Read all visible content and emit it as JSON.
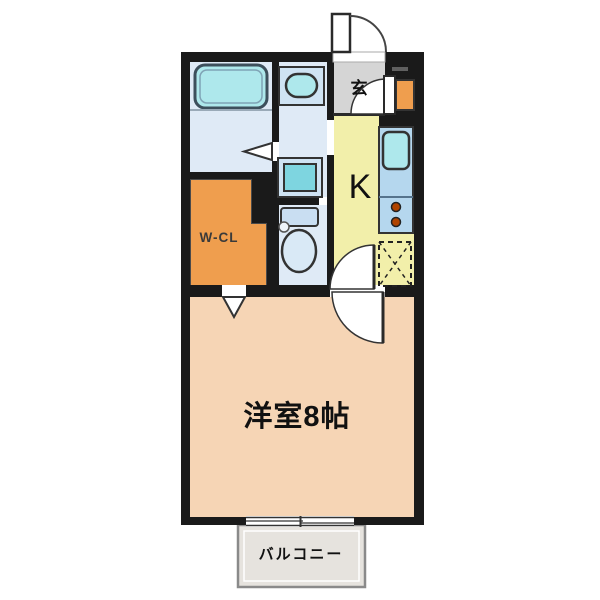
{
  "floor_plan": {
    "rooms": {
      "main_room": {
        "label": "洋室8帖"
      },
      "kitchen": {
        "label": "K"
      },
      "walk_in_closet": {
        "label": "W-CL"
      },
      "entrance": {
        "label": "玄"
      },
      "balcony": {
        "label": "バルコニー"
      }
    },
    "fixtures": [
      "bathtub",
      "washbasin",
      "washing-machine-space",
      "toilet",
      "kitchen-sink",
      "gas-stove-2-burner",
      "refrigerator-space",
      "shoe-cabinet",
      "entrance-door",
      "interior-doors",
      "folding-bath-door",
      "closet-door",
      "sliding-window"
    ],
    "colors": {
      "wall": "#1a1a1a",
      "wet_room_floor": "#dfeaf6",
      "fixture_cyan": "#aee8ec",
      "kitchen_floor": "#f2efaa",
      "main_room_floor": "#f6d5b5",
      "closet_orange": "#ef9e4e",
      "entrance_gray": "#d5d5d5",
      "balcony_gray": "#e6e3de",
      "counter_blue": "#b5d7ee",
      "burner_red": "#b04400"
    }
  }
}
